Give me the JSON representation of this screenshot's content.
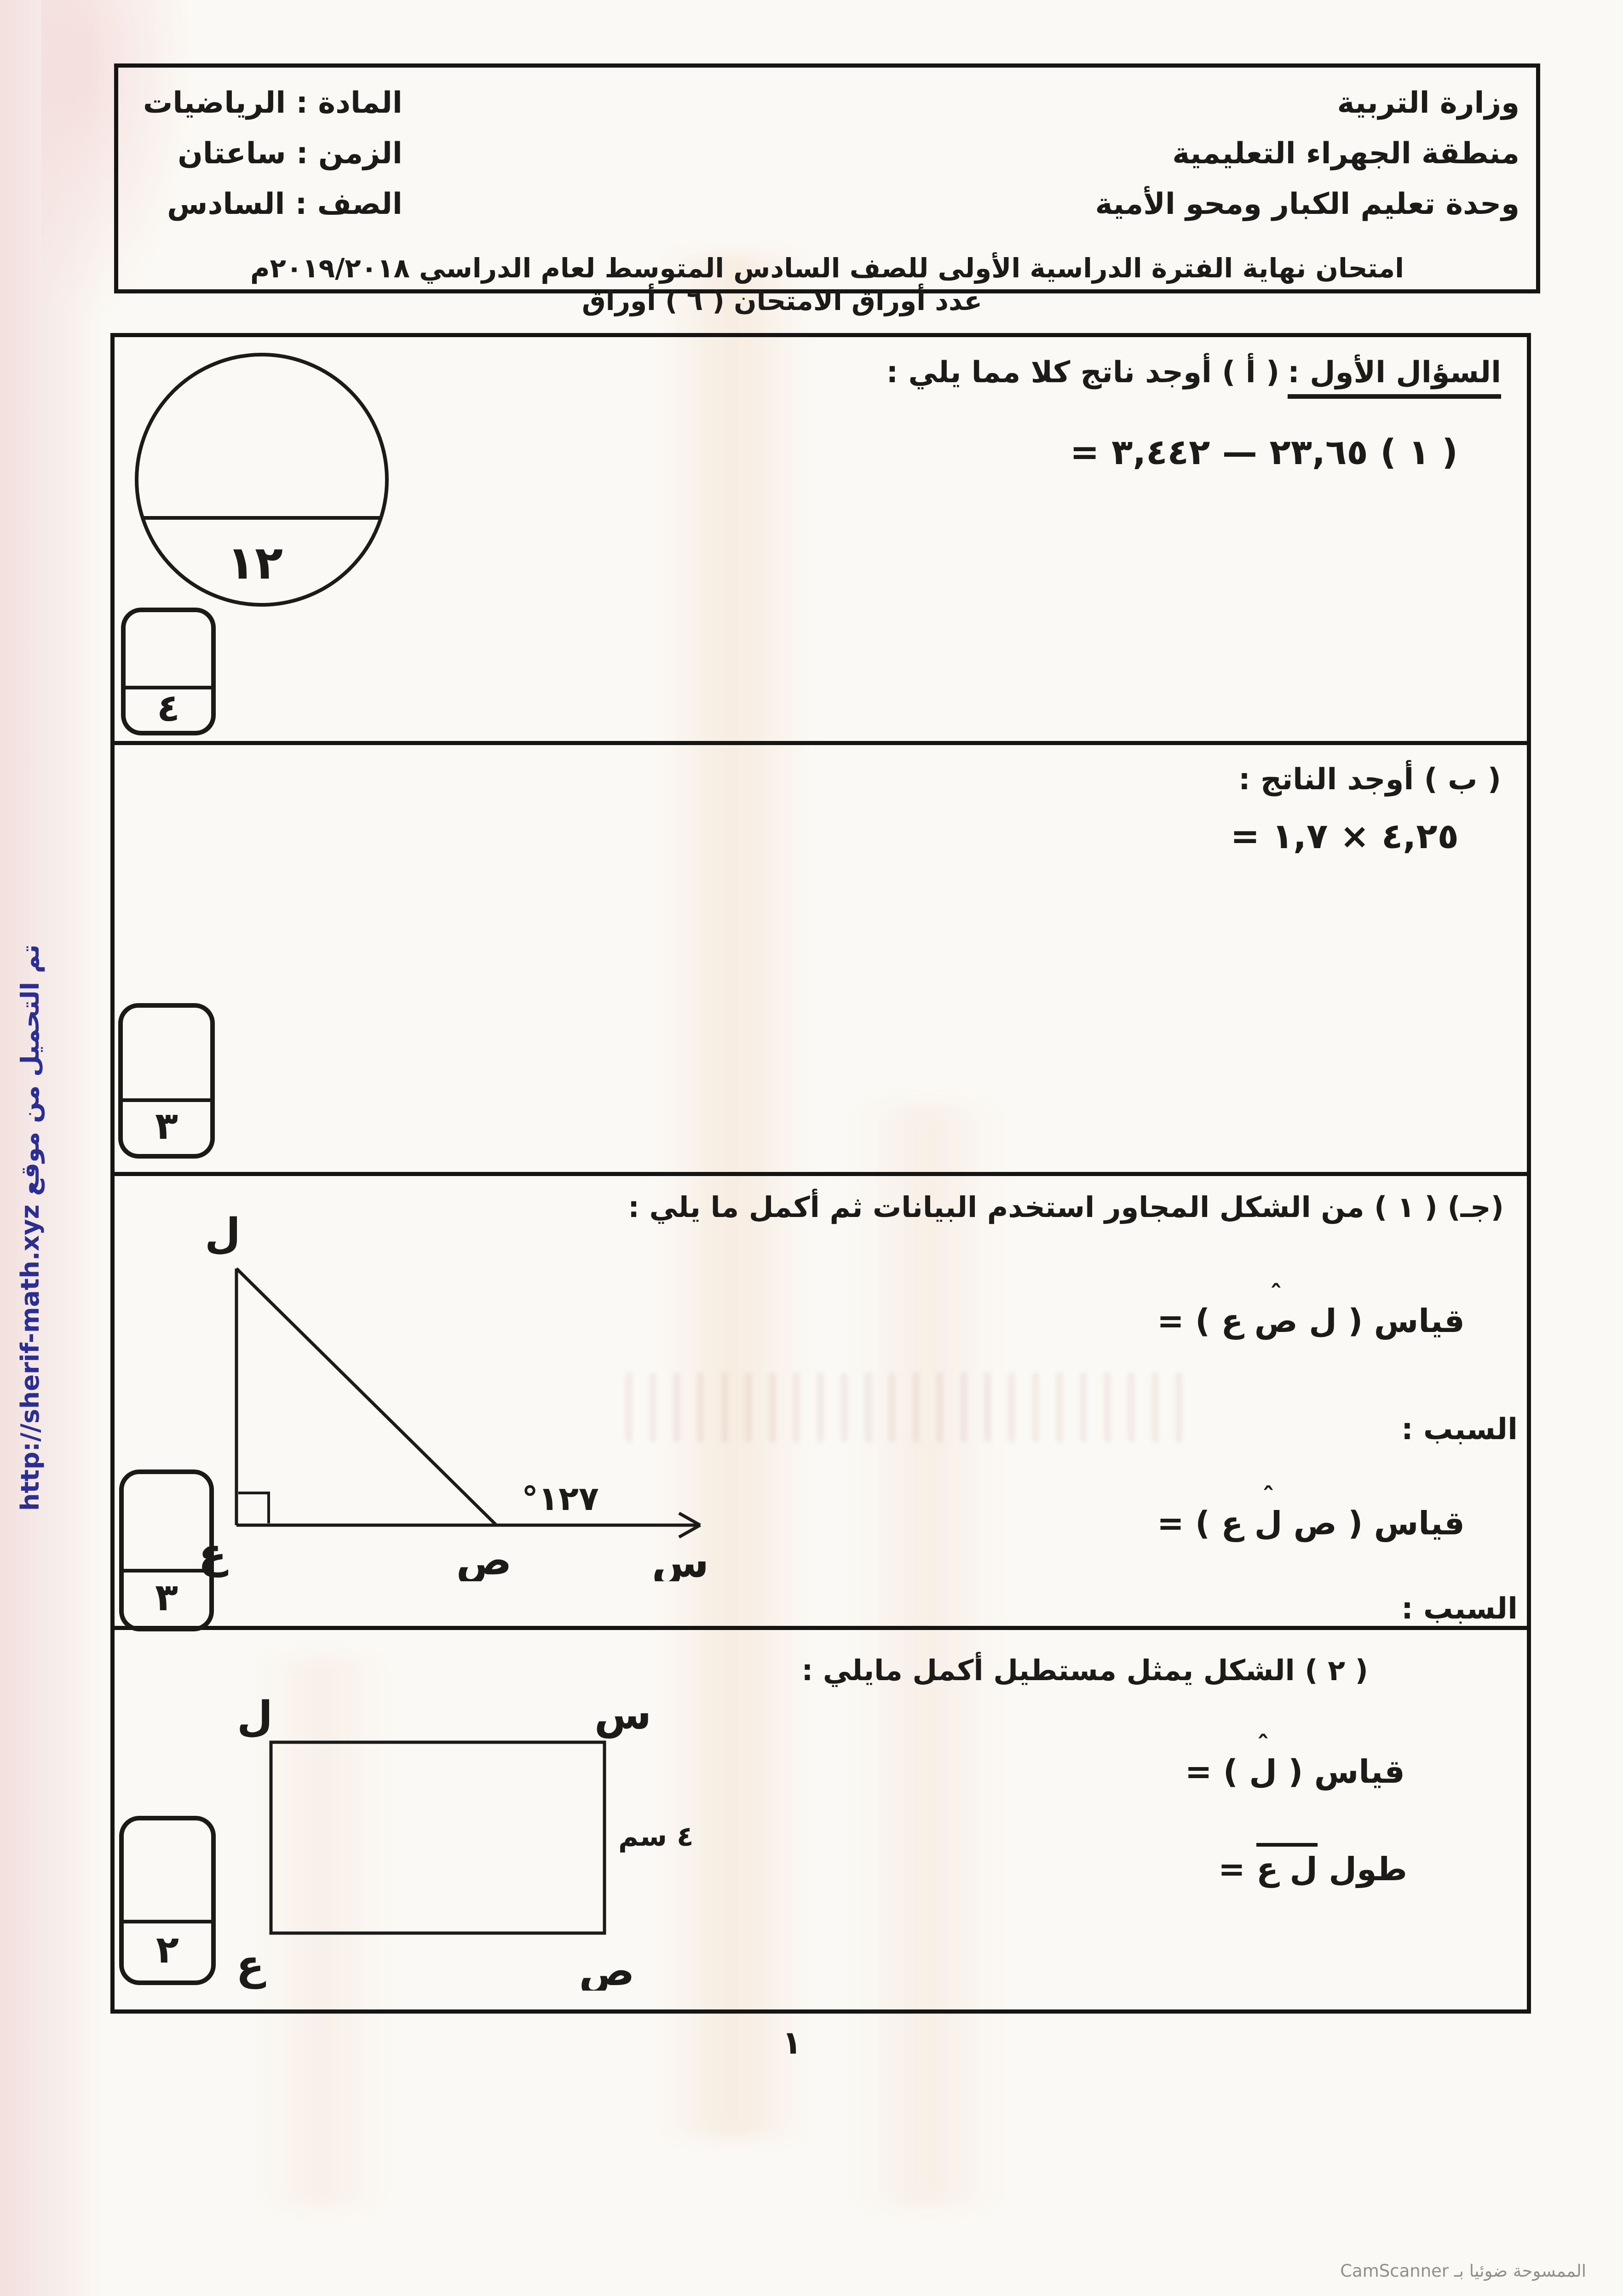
{
  "header": {
    "ministry": "وزارة التربية",
    "district": "منطقة الجهراء التعليمية",
    "unit": "وحدة تعليم الكبار ومحو الأمية",
    "subject": "المادة :  الرياضيات",
    "time": "الزمن : ساعتان",
    "grade": "الصف :   السادس",
    "exam_title": "امتحان نهاية الفترة الدراسية الأولى للصف السادس المتوسط  لعام الدراسي ٢٠١٩/٢٠١٨م",
    "sheets_count": "عدد أوراق الامتحان ( ٦ ) أوراق"
  },
  "total_marks": "١٢",
  "q1a": {
    "title_underlined": "السؤال الأول :",
    "title_rest": "( أ )  أوجد ناتج كلا مما يلي :",
    "equation": "( ١ )  ٢٣,٦٥ — ٣,٤٤٢ =",
    "marks": "٤"
  },
  "q1b": {
    "title": "( ب ) أوجد الناتج :",
    "equation": "٤,٢٥ × ١,٧ =",
    "marks": "٣"
  },
  "q1c": {
    "title": "(جـ) ( ١ ) من الشكل المجاور استخدم البيانات ثم  أكمل ما يلي :",
    "measure1_prefix": "قياس ( ل ",
    "measure1_hatted": "ص",
    "measure1_suffix": " ع ) =",
    "reason1": "السبب :",
    "measure2_prefix": "قياس ( ص ",
    "measure2_hatted": "ل",
    "measure2_suffix": " ع ) =",
    "reason2": "السبب :",
    "marks": "٣",
    "triangle": {
      "apex": "ل",
      "corner": "ع",
      "point": "ص",
      "ray": "س",
      "angle_label": "°١٢٧"
    }
  },
  "q2": {
    "title": "( ٢ ) الشكل يمثل مستطيل  أكمل مايلي :",
    "measure_prefix": "قياس ( ",
    "measure_hatted": "ل",
    "measure_suffix": " ) =",
    "length_prefix": "طول ",
    "length_overlined": "ل ع",
    "length_suffix": " =",
    "marks": "٢",
    "rect": {
      "top_left": "ل",
      "top_right": "س",
      "bottom_left": "ع",
      "bottom_right": "ص",
      "side_label": "٤ سم"
    }
  },
  "footer": {
    "page_number": "١",
    "scanner": "الممسوحة ضوئيا بـ CamScanner"
  },
  "watermark": "تم التحميل من موقع http://sherif-math.xyz",
  "symbols": {
    "hat": "ˆ"
  },
  "colors": {
    "ink": "#1d1b1a",
    "link_blue": "#2b2f92",
    "scanner_gray": "#8f8f8f",
    "paper": "#fbf9f5"
  }
}
